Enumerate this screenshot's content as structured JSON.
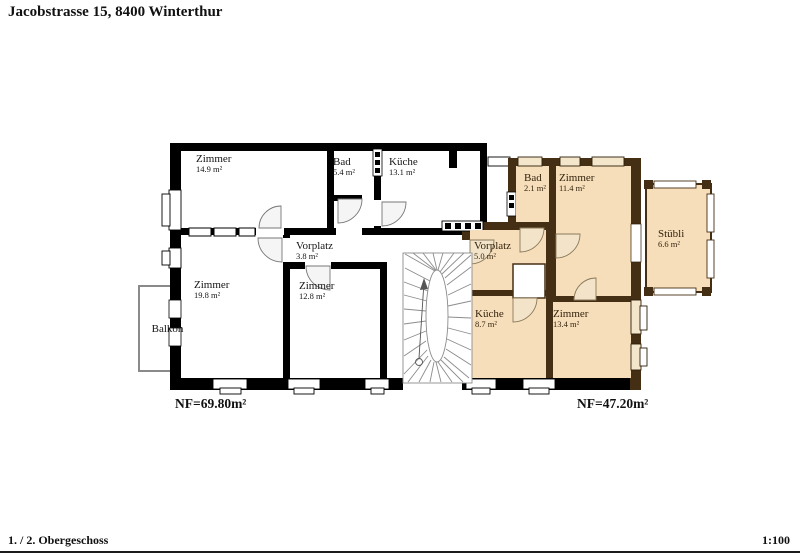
{
  "title": "Jacobstrasse 15, 8400 Winterthur",
  "footer": {
    "label": "1. / 2. Obergeschoss",
    "scale": "1:100"
  },
  "plan": {
    "left_unit": {
      "nf": "NF=69.80m²",
      "balcony": "Balkon",
      "rooms": [
        {
          "name": "Zimmer",
          "area": "14.9 m²"
        },
        {
          "name": "Bad",
          "area": "5.4 m²"
        },
        {
          "name": "Küche",
          "area": "13.1 m²"
        },
        {
          "name": "Vorplatz",
          "area": "3.8 m²"
        },
        {
          "name": "Zimmer",
          "area": "19.8 m²"
        },
        {
          "name": "Zimmer",
          "area": "12.8 m²"
        }
      ]
    },
    "right_unit": {
      "nf": "NF=47.20m²",
      "rooms": [
        {
          "name": "Bad",
          "area": "2.1 m²"
        },
        {
          "name": "Zimmer",
          "area": "11.4 m²"
        },
        {
          "name": "Vorplatz",
          "area": "5.0 m²"
        },
        {
          "name": "Küche",
          "area": "8.7 m²"
        },
        {
          "name": "Zimmer",
          "area": "13.4 m²"
        },
        {
          "name": "Stübli",
          "area": "6.6 m²"
        }
      ]
    },
    "colors": {
      "left_wall": "#000000",
      "right_wall": "#452f14",
      "right_room_fill": "#f7debb",
      "balcony_outline": "#8a8a8a"
    }
  }
}
